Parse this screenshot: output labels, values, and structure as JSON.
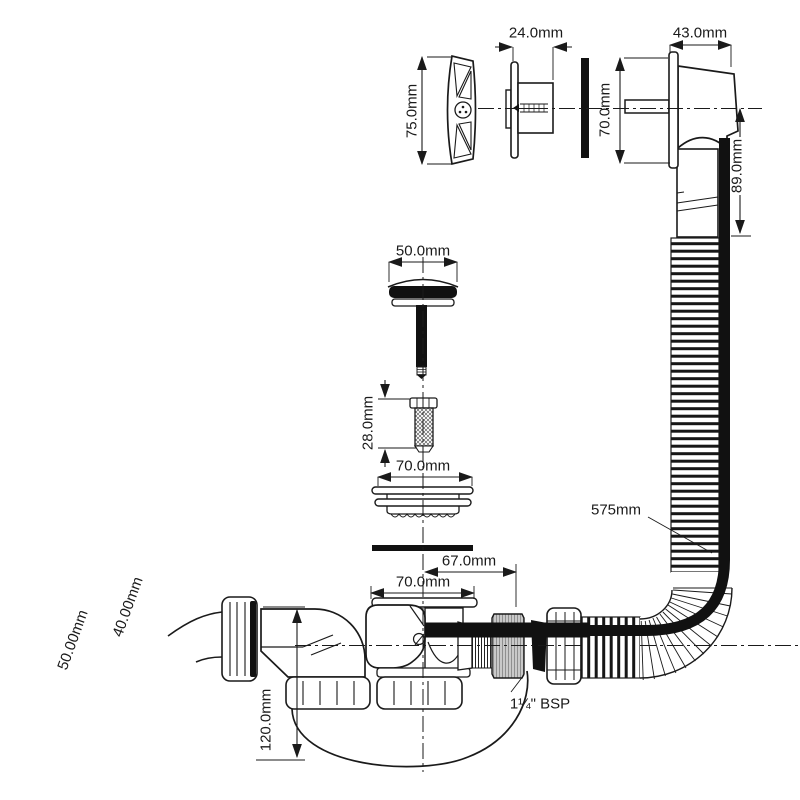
{
  "diagram": {
    "dimensions": {
      "dial_height": "75.0mm",
      "faceplate_depth": "24.0mm",
      "overflow_body_depth": "43.0mm",
      "overflow_body_height": "70.0mm",
      "overflow_pipe_drop": "89.0mm",
      "plug_cap_diameter": "50.0mm",
      "grub_screw_length": "28.0mm",
      "waste_flange_diameter": "70.0mm",
      "hose_length": "575mm",
      "trap_offset": "67.0mm",
      "trap_inlet_diameter": "70.0mm",
      "trap_height": "120.0mm",
      "outlet_pipe_inner": "40.00mm",
      "outlet_pipe_outer": "50.00mm",
      "thread_size": "1¼\" BSP"
    },
    "colors": {
      "line": "#1a1a1a",
      "thread_fill": "#c9c9c9",
      "background": "#ffffff"
    }
  }
}
